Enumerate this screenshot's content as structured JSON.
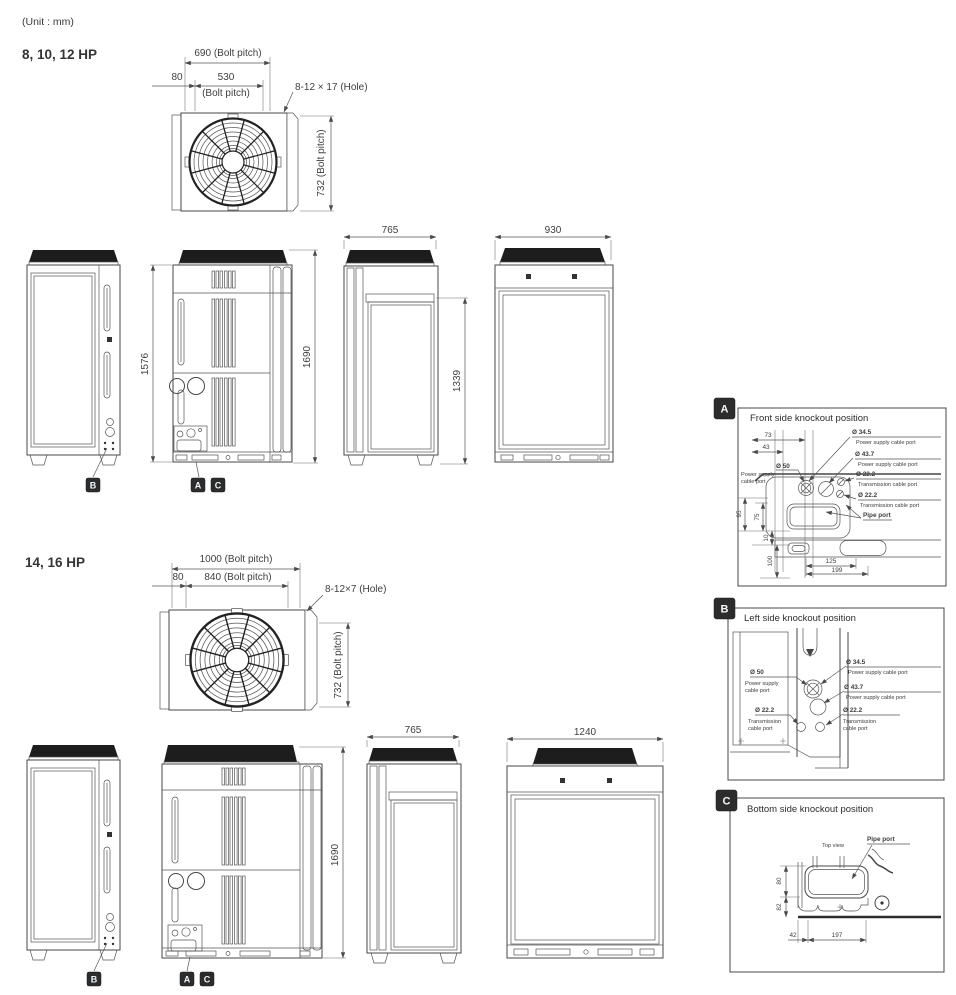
{
  "unit_note": "(Unit : mm)",
  "badges": {
    "a": "A",
    "b": "B",
    "c": "C"
  },
  "section1": {
    "heading": "8, 10, 12 HP",
    "top": {
      "outer_pitch": "690 (Bolt pitch)",
      "offset": "80",
      "inner_pitch": "530",
      "inner_pitch_sub": "(Bolt pitch)",
      "hole": "8-12 × 17 (Hole)",
      "vert_pitch": "732 (Bolt pitch)"
    },
    "front_h1": "1576",
    "front_h2": "1690",
    "side_w": "765",
    "side_h": "1339",
    "rear_w": "930"
  },
  "section2": {
    "heading": "14, 16 HP",
    "top": {
      "outer_pitch": "1000 (Bolt pitch)",
      "offset": "80",
      "inner_pitch": "840 (Bolt pitch)",
      "hole": "8-12×7 (Hole)",
      "vert_pitch": "732 (Bolt pitch)"
    },
    "front_h2": "1690",
    "side_w": "765",
    "rear_w": "1240"
  },
  "panel_a": {
    "title": "Front side knockout position",
    "d73": "73",
    "d43": "43",
    "p345": "Ø 34.5",
    "p345_desc": "Power supply cable port",
    "p437": "Ø 43.7",
    "p437_desc": "Power supply cable port",
    "p50": "Ø 50",
    "p50_desc1": "Power supply",
    "p50_desc2": "cable port",
    "p222a": "Ø 22.2",
    "p222a_desc": "Transmission cable  port",
    "p222b": "Ø 22.2",
    "p222b_desc": "Transmission cable  port",
    "pipe": "Pipe port",
    "d95": "95",
    "d75": "75",
    "d10": "10",
    "d100": "100",
    "d125": "125",
    "d199": "199"
  },
  "panel_b": {
    "title": "Left side knockout position",
    "p50": "Ø 50",
    "p50_desc1": "Power supply",
    "p50_desc2": "cable port",
    "p345": "Ø 34.5",
    "p345_desc": "Power supply cable port",
    "p437": "Ø 43.7",
    "p437_desc": "Power supply cable port",
    "p222a": "Ø 22.2",
    "p222a_desc1": "Transmission",
    "p222a_desc2": "cable port",
    "p222b": "Ø 22.2",
    "p222b_desc1": "Transmission",
    "p222b_desc2": "cable  port"
  },
  "panel_c": {
    "title": "Bottom side knockout position",
    "top_view": "Top view",
    "pipe": "Pipe port",
    "d80": "80",
    "d82": "82",
    "d42": "42",
    "d197": "197"
  }
}
